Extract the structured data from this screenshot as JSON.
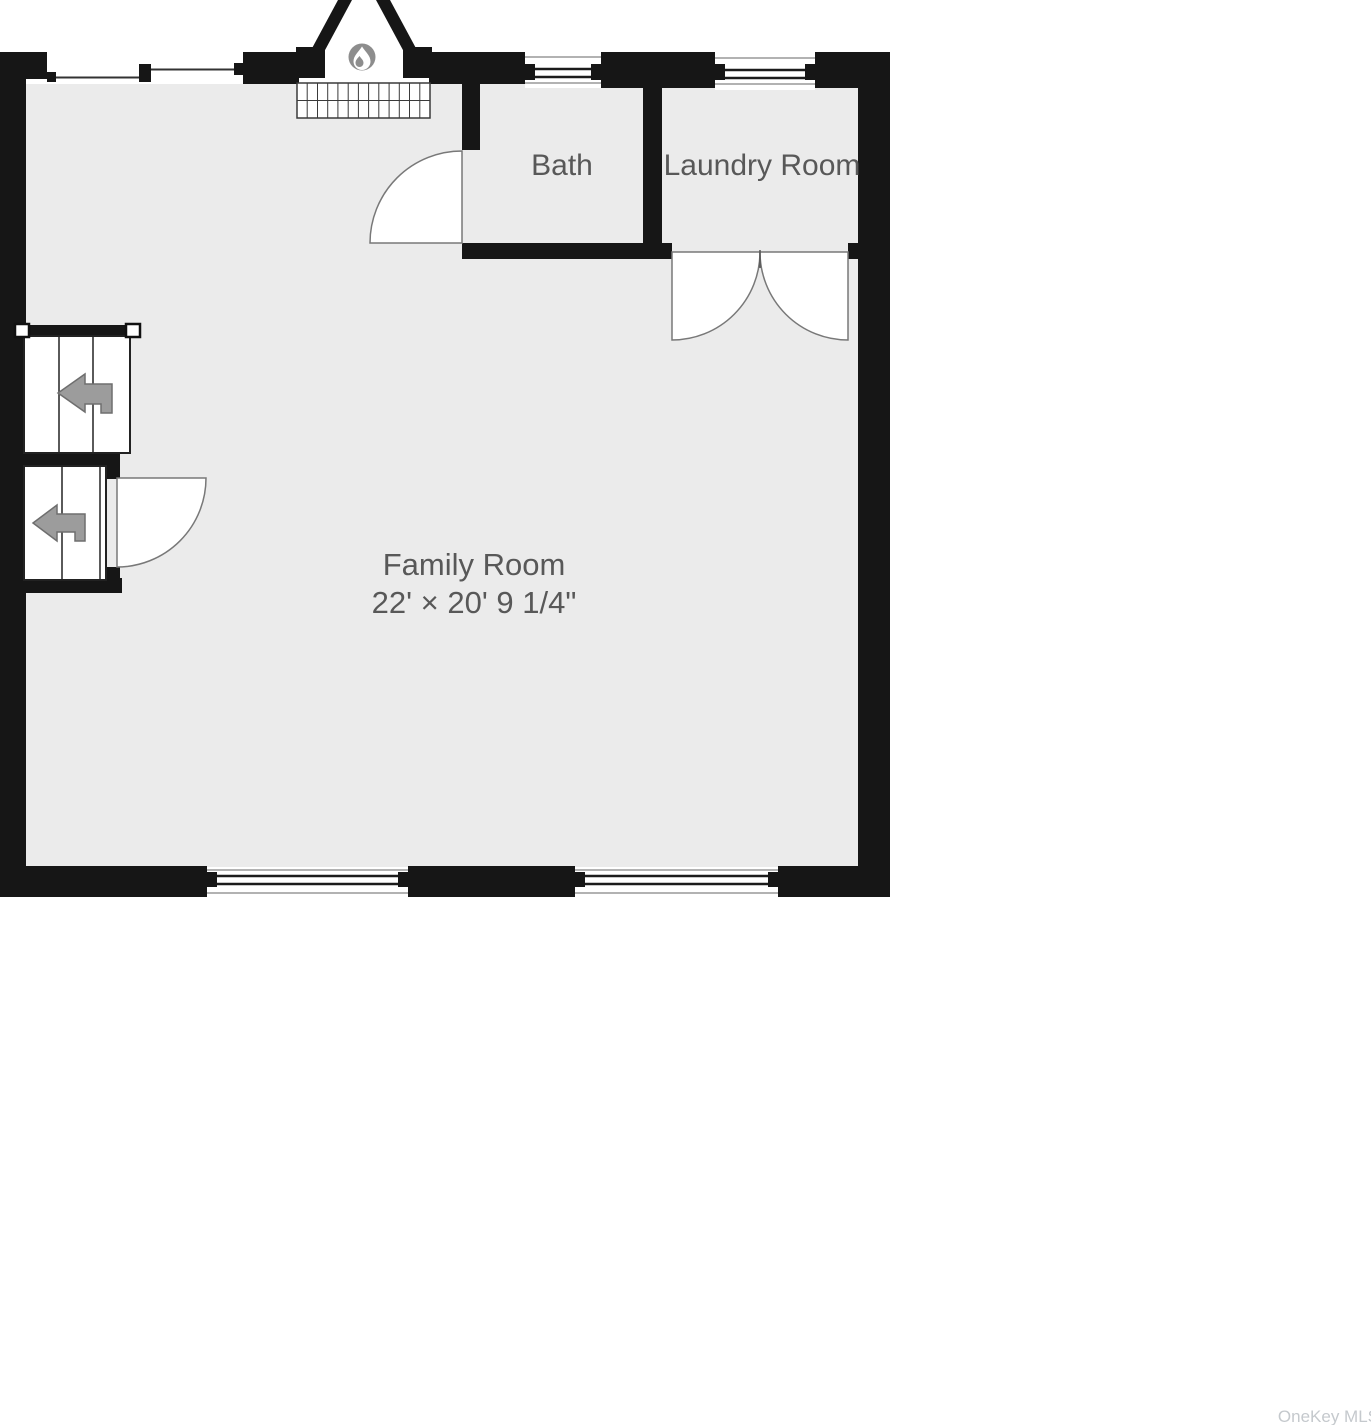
{
  "plan": {
    "type": "floor-plan",
    "rooms": {
      "family": {
        "name": "Family Room",
        "dimensions": "22' × 20' 9 1/4\""
      },
      "bath": {
        "name": "Bath"
      },
      "laundry": {
        "name": "Laundry Room"
      }
    },
    "features": {
      "fireplace_icon": "flame-icon",
      "stairs_up_icon": "left-arrow-icon",
      "stairs_down_icon": "left-arrow-icon"
    },
    "colors": {
      "wall": "#161616",
      "floor": "#ebebeb",
      "label_text": "#585858",
      "door_stroke": "#787878",
      "arrow_fill": "#9c9c9c",
      "fireplace_disc": "#8d8d8d",
      "watermark_text": "#c5c9cd"
    }
  },
  "watermark": {
    "text": "OneKey MLS"
  }
}
